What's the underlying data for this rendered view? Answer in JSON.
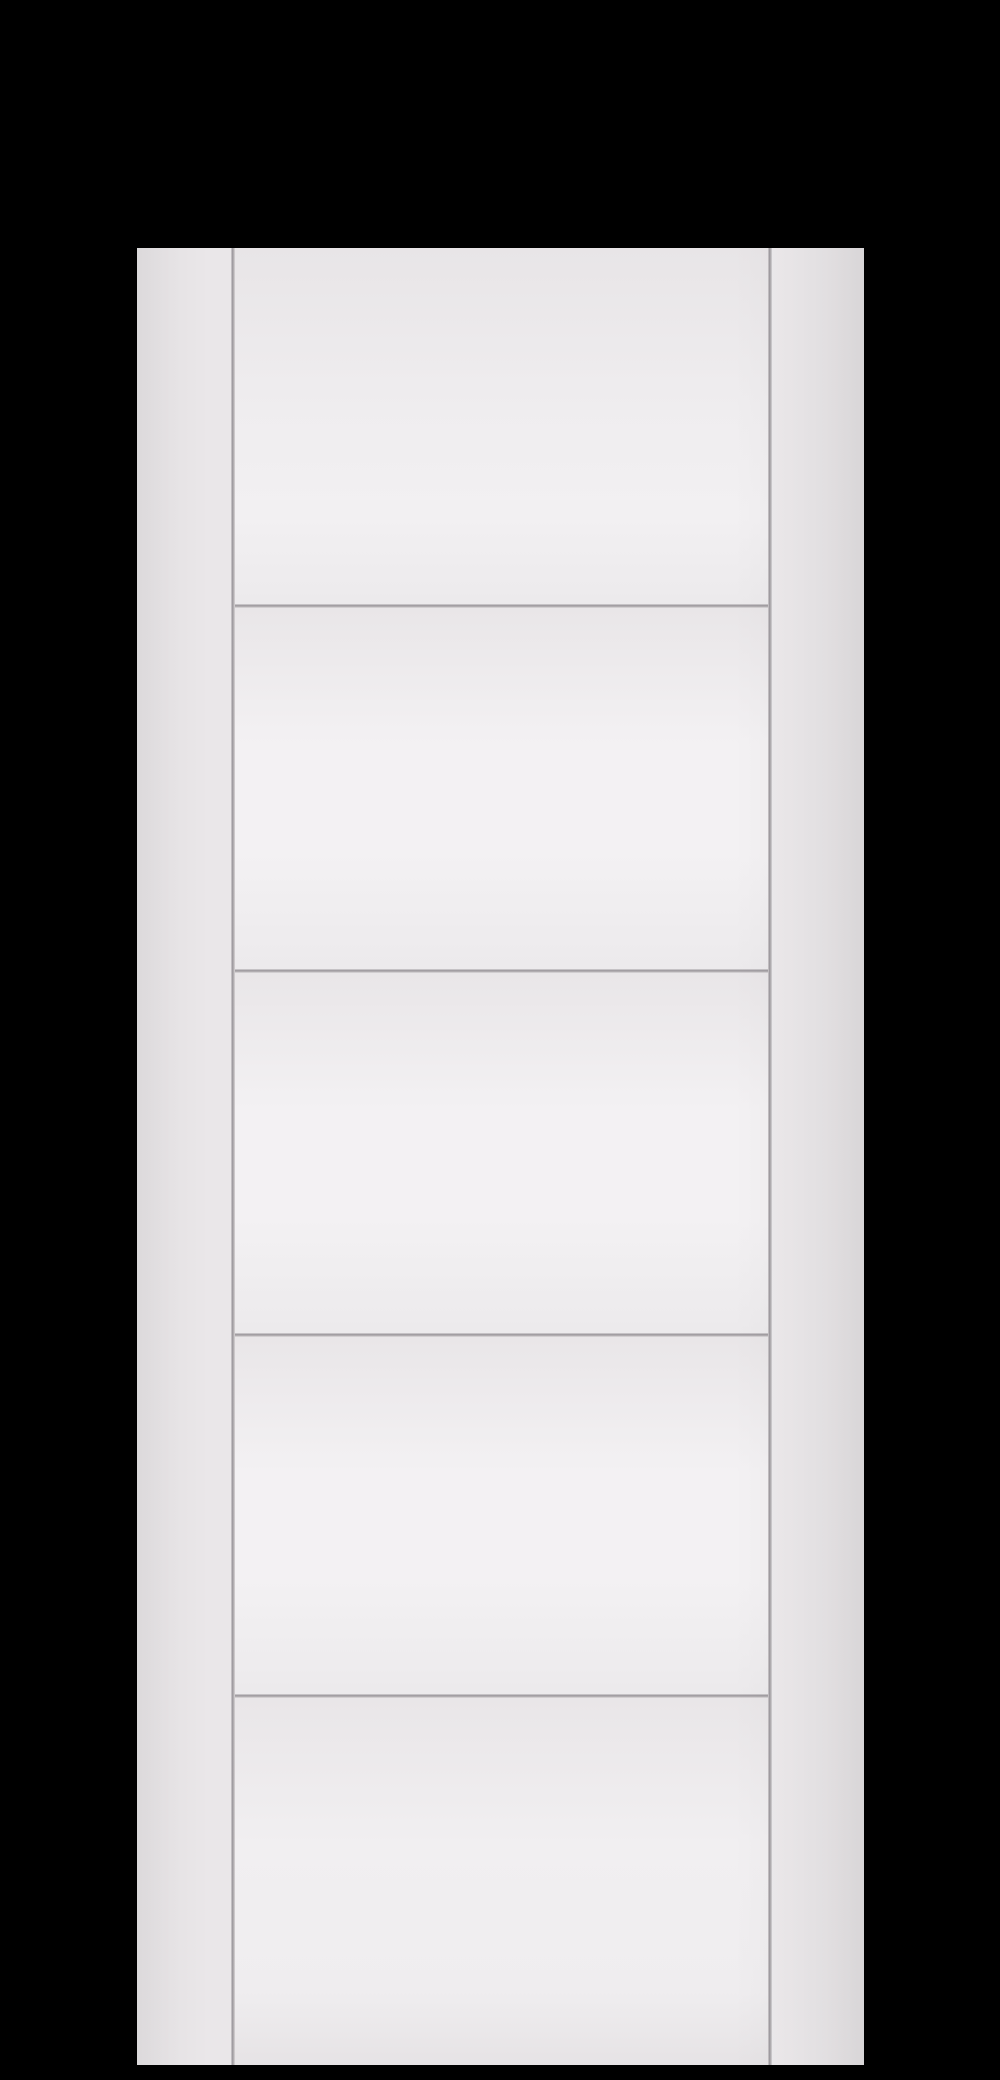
{
  "scene": {
    "description": "Product photograph of a plain white primed five-panel ladder-style interior door slab, shown upright and centered on a solid black background",
    "door": {
      "style": "5-panel horizontal groove (ladder) door",
      "panel_count": 5,
      "panels": [
        {
          "label": "panel-1"
        },
        {
          "label": "panel-2"
        },
        {
          "label": "panel-3"
        },
        {
          "label": "panel-4"
        },
        {
          "label": "panel-5"
        }
      ],
      "vertical_grooves": 2,
      "horizontal_grooves": 4,
      "hardware": "none"
    }
  },
  "colors": {
    "background": "#000000",
    "door_face": "#eceaec",
    "stile": "#eae7e9",
    "stile_dark": "#e4e1e3",
    "panel_light": "#f3f1f3",
    "panel_shade": "#e9e6e8",
    "groove_dark": "#99959a",
    "groove_mid": "#b3afb2",
    "groove_light": "#d9d6d8"
  }
}
